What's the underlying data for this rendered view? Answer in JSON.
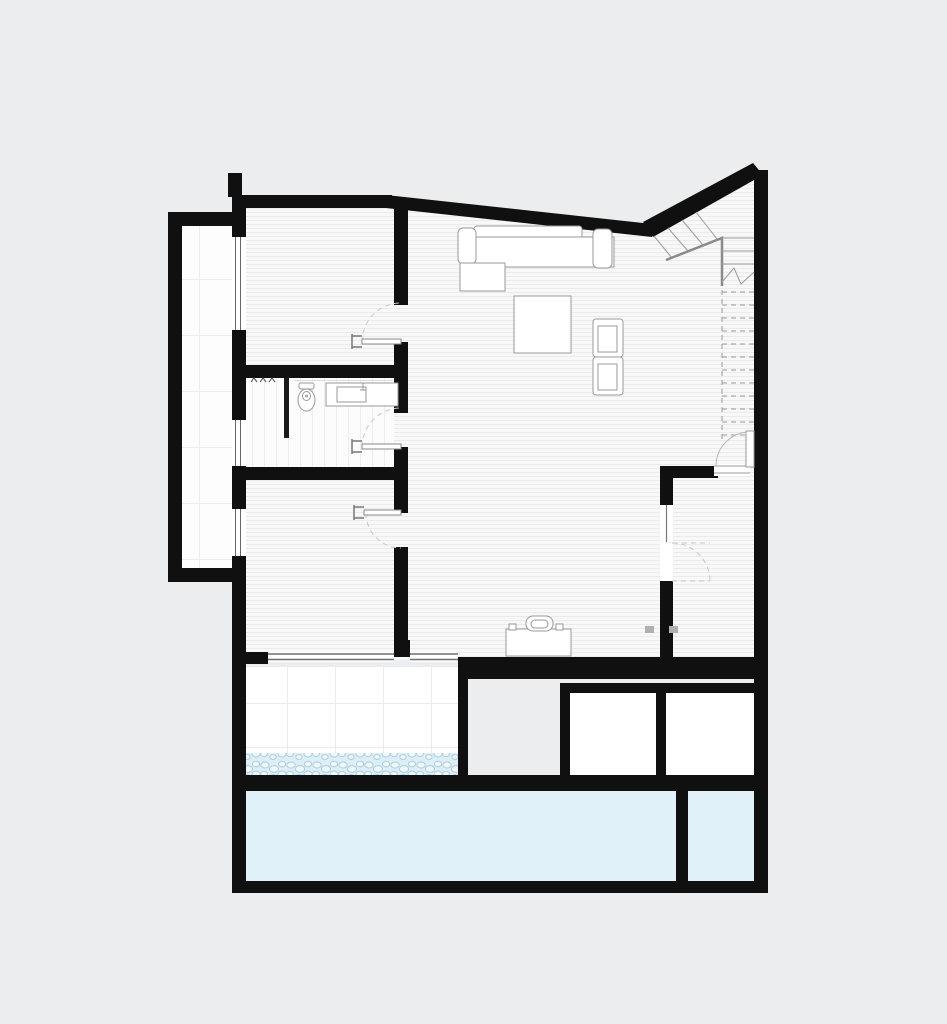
{
  "page": {
    "background": "#ebedee",
    "kind": "architectural-floor-plan"
  },
  "plan": {
    "colors": {
      "wall": "#101010",
      "floor": "#f8f8f8",
      "floor_hatch_line": "#ebebeb",
      "tile_line": "#ececec",
      "bath_tile_line": "#ededed",
      "pool_water": "#e0f1fa",
      "pebble_bg": "#ddeef6",
      "pebble_fill": "#f0f8fc",
      "pebble_stroke": "#a9cfdd",
      "furniture_line": "#9a9a9a",
      "door_leaf": "#8a8a8a",
      "door_arc": "#c8c8c8",
      "stair_line": "#9a9a9a",
      "patio": "#ebedee",
      "white": "#ffffff"
    },
    "areas": [
      {
        "id": "balcony-strip",
        "finish": "white-tile"
      },
      {
        "id": "bedroom-upper",
        "finish": "hatched-floor"
      },
      {
        "id": "shower-room",
        "finish": "white-tile"
      },
      {
        "id": "bathroom",
        "finish": "white-tile"
      },
      {
        "id": "bedroom-lower",
        "finish": "hatched-floor"
      },
      {
        "id": "living-room",
        "finish": "hatched-floor"
      },
      {
        "id": "stair-hall",
        "finish": "hatched-floor"
      },
      {
        "id": "utility-room",
        "finish": "hatched-floor"
      },
      {
        "id": "terrace",
        "finish": "white-tile"
      },
      {
        "id": "patio",
        "finish": "grey-ground"
      },
      {
        "id": "storage-room-1",
        "finish": "white"
      },
      {
        "id": "storage-room-2",
        "finish": "white"
      },
      {
        "id": "pebble-border",
        "finish": "pebbles"
      },
      {
        "id": "pool-main",
        "finish": "water"
      },
      {
        "id": "pool-small",
        "finish": "water"
      }
    ],
    "furniture": [
      "corner-sofa",
      "coffee-table",
      "armchair-1",
      "armchair-2",
      "desk",
      "desk-chair",
      "toilet",
      "washbasin-counter"
    ],
    "openings": {
      "hinged_doors": 5,
      "sliding_glass_panels": 2,
      "facade_windows": 5
    },
    "stair": {
      "winder_treads": 4,
      "solid_treads": 3,
      "dashed_treads": 12
    }
  }
}
